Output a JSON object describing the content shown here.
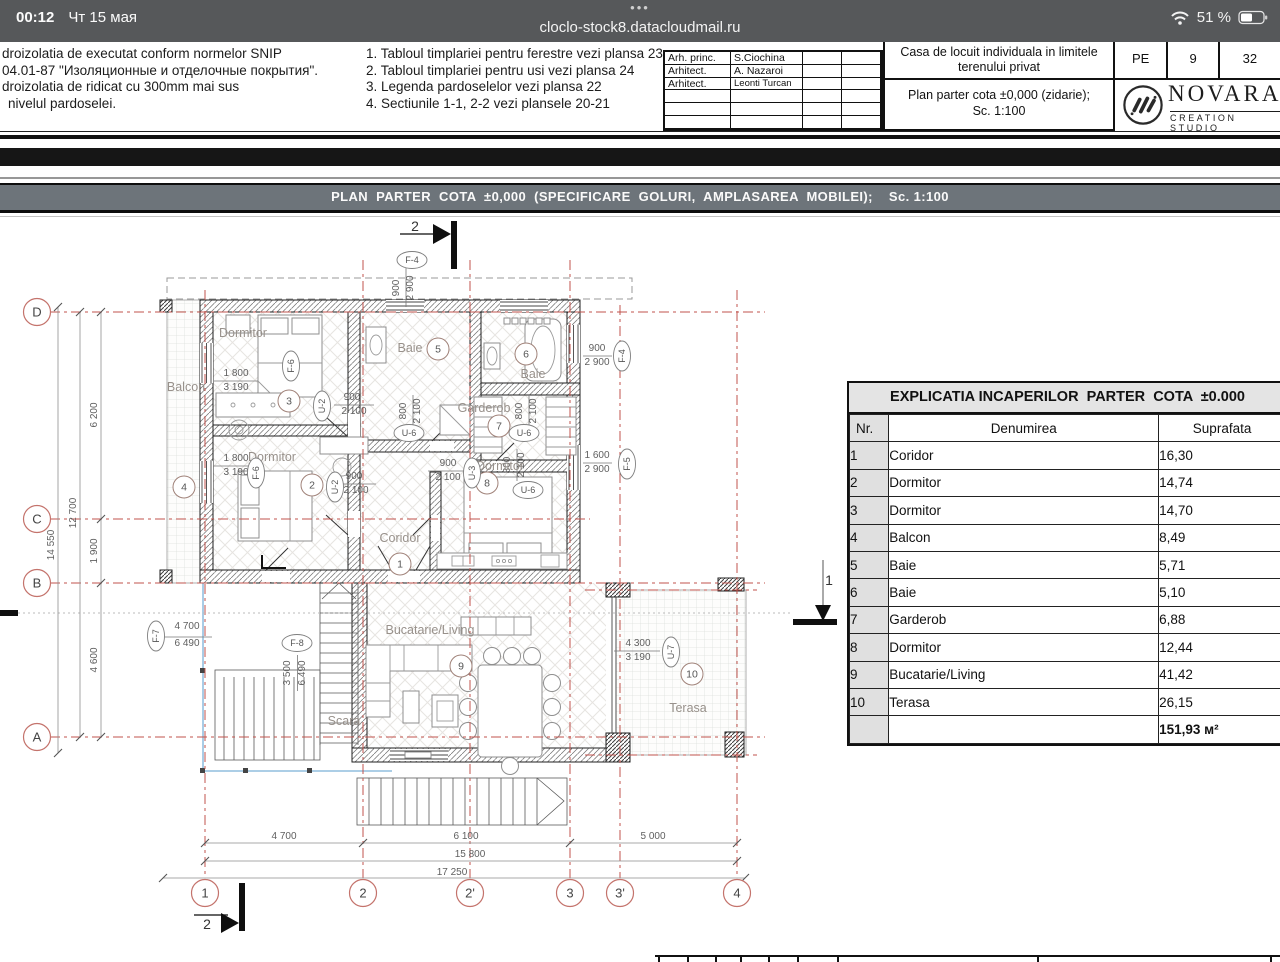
{
  "colors": {
    "accent_red": "#c0534c",
    "line_blue": "#7bb0d8",
    "banner_bg": "#6d747a",
    "status_bg": "#56585a"
  },
  "status_bar": {
    "time": "00:12",
    "date": "Чт 15 мая",
    "menu_dots": "•••",
    "url": "cloclo-stock8.datacloudmail.ru",
    "battery_percent": "51 %"
  },
  "title_block": {
    "notes_left": [
      "droizolatia de executat conform normelor SNIP",
      "04.01-87 \"Изоляционные и отделочные покрытия\".",
      "droizolatia de ridicat cu 300mm mai sus",
      "nivelul pardoselei."
    ],
    "notes_right": [
      "1. Tabloul timplariei pentru ferestre vezi plansa 23",
      "2. Tabloul timplariei pentru usi vezi plansa 24",
      "3. Legenda pardoselelor  vezi plansa 22",
      "4. Sectiunile 1-1, 2-2 vezi plansele 20-21"
    ],
    "roles": [
      {
        "role": "Arh. princ.",
        "name": "S.Ciochina"
      },
      {
        "role": "Arhitect.",
        "name": "A. Nazaroi"
      },
      {
        "role": "Arhitect.",
        "name": "Leonti Turcan"
      }
    ],
    "project_title": "Casa de locuit individuala in limitele terenului privat",
    "drawing_title": "Plan parter cota ±0,000 (zidarie);",
    "drawing_scale": "Sc. 1:100",
    "stage": "PE",
    "sheet_no": "9",
    "sheet_total": "32",
    "logo_name": "NOVARA",
    "logo_sub": "CREATION STUDIO"
  },
  "banner": {
    "text": "PLAN  PARTER  COTA  ±0,000  (SPECIFICARE  GOLURI,  AMPLASAREA  MOBILEI);    Sc. 1:100"
  },
  "plan": {
    "axis_letters": [
      {
        "t": "D",
        "x": 37,
        "y": 97
      },
      {
        "t": "C",
        "x": 37,
        "y": 304
      },
      {
        "t": "B",
        "x": 37,
        "y": 368
      },
      {
        "t": "A",
        "x": 37,
        "y": 522
      }
    ],
    "axis_numbers": [
      {
        "t": "1",
        "x": 205,
        "y": 678
      },
      {
        "t": "2",
        "x": 363,
        "y": 678
      },
      {
        "t": "2'",
        "x": 470,
        "y": 678
      },
      {
        "t": "3",
        "x": 570,
        "y": 678
      },
      {
        "t": "3'",
        "x": 620,
        "y": 678
      },
      {
        "t": "4",
        "x": 737,
        "y": 678
      }
    ],
    "circles": [
      {
        "t": "1",
        "x": 400,
        "y": 349
      },
      {
        "t": "2",
        "x": 312,
        "y": 270
      },
      {
        "t": "3",
        "x": 289,
        "y": 186
      },
      {
        "t": "4",
        "x": 184,
        "y": 272
      },
      {
        "t": "5",
        "x": 438,
        "y": 134
      },
      {
        "t": "6",
        "x": 526,
        "y": 139
      },
      {
        "t": "7",
        "x": 499,
        "y": 211
      },
      {
        "t": "8",
        "x": 487,
        "y": 268
      },
      {
        "t": "9",
        "x": 461,
        "y": 451
      },
      {
        "t": "10",
        "x": 692,
        "y": 459
      }
    ],
    "bubbles": [
      {
        "t": "F-4",
        "x": 412,
        "y": 45
      },
      {
        "t": "F-4",
        "x": 622,
        "y": 141,
        "v": 1
      },
      {
        "t": "F-5",
        "x": 627,
        "y": 249,
        "v": 1
      },
      {
        "t": "F-6",
        "x": 291,
        "y": 151,
        "v": 1
      },
      {
        "t": "F-6",
        "x": 256,
        "y": 258,
        "v": 1
      },
      {
        "t": "F-7",
        "x": 156,
        "y": 421,
        "v": 1
      },
      {
        "t": "F-8",
        "x": 297,
        "y": 428
      },
      {
        "t": "U-2",
        "x": 322,
        "y": 191,
        "v": 1
      },
      {
        "t": "U-2",
        "x": 335,
        "y": 272,
        "v": 1
      },
      {
        "t": "U-3",
        "x": 472,
        "y": 258,
        "v": 1
      },
      {
        "t": "U-6",
        "x": 409,
        "y": 218
      },
      {
        "t": "U-6",
        "x": 524,
        "y": 218
      },
      {
        "t": "U-6",
        "x": 528,
        "y": 275
      },
      {
        "t": "U-7",
        "x": 671,
        "y": 437,
        "v": 1
      }
    ],
    "rooms": [
      {
        "t": "Dormitor",
        "x": 243,
        "y": 122
      },
      {
        "t": "Dormitor",
        "x": 272,
        "y": 246
      },
      {
        "t": "Dormitor",
        "x": 500,
        "y": 255
      },
      {
        "t": "Baie",
        "x": 410,
        "y": 137
      },
      {
        "t": "Baie",
        "x": 533,
        "y": 163
      },
      {
        "t": "Garderob",
        "x": 484,
        "y": 197
      },
      {
        "t": "Coridor",
        "x": 400,
        "y": 327
      },
      {
        "t": "Balcon",
        "x": 186,
        "y": 176
      },
      {
        "t": "Bucatarie/Living",
        "x": 430,
        "y": 419
      },
      {
        "t": "Scara",
        "x": 344,
        "y": 510
      },
      {
        "t": "Terasa",
        "x": 688,
        "y": 497
      }
    ],
    "texts": [
      {
        "t": "14 550",
        "x": 54,
        "y": 330,
        "r": -90
      },
      {
        "t": "12 700",
        "x": 76,
        "y": 298,
        "r": -90
      },
      {
        "t": "6 200",
        "x": 97,
        "y": 200,
        "r": -90
      },
      {
        "t": "1 900",
        "x": 97,
        "y": 336,
        "r": -90
      },
      {
        "t": "4 600",
        "x": 97,
        "y": 445,
        "r": -90
      },
      {
        "t": "4 700",
        "x": 284,
        "y": 624
      },
      {
        "t": "6 100",
        "x": 466,
        "y": 624
      },
      {
        "t": "5 000",
        "x": 653,
        "y": 624
      },
      {
        "t": "15 800",
        "x": 470,
        "y": 642
      },
      {
        "t": "17 250",
        "x": 452,
        "y": 660
      },
      {
        "t": "900",
        "x": 399,
        "y": 73,
        "r": -90
      },
      {
        "t": "2 900",
        "x": 413,
        "y": 73,
        "r": -90
      },
      {
        "t": "900",
        "x": 597,
        "y": 136
      },
      {
        "t": "2 900",
        "x": 597,
        "y": 150
      },
      {
        "t": "1 600",
        "x": 597,
        "y": 243
      },
      {
        "t": "2 900",
        "x": 597,
        "y": 257
      },
      {
        "t": "1 800",
        "x": 236,
        "y": 161
      },
      {
        "t": "3 190",
        "x": 236,
        "y": 175
      },
      {
        "t": "1 800",
        "x": 236,
        "y": 246
      },
      {
        "t": "3 190",
        "x": 236,
        "y": 260
      },
      {
        "t": "900",
        "x": 352,
        "y": 185
      },
      {
        "t": "2 100",
        "x": 354,
        "y": 199
      },
      {
        "t": "900",
        "x": 354,
        "y": 264
      },
      {
        "t": "2 100",
        "x": 356,
        "y": 278
      },
      {
        "t": "900",
        "x": 448,
        "y": 251
      },
      {
        "t": "2 100",
        "x": 448,
        "y": 265
      },
      {
        "t": "800",
        "x": 406,
        "y": 196,
        "r": -90
      },
      {
        "t": "2 100",
        "x": 420,
        "y": 196,
        "r": -90
      },
      {
        "t": "800",
        "x": 522,
        "y": 196,
        "r": -90
      },
      {
        "t": "2 100",
        "x": 536,
        "y": 196,
        "r": -90
      },
      {
        "t": "800",
        "x": 510,
        "y": 250,
        "r": -90
      },
      {
        "t": "2 100",
        "x": 524,
        "y": 250,
        "r": -90
      },
      {
        "t": "4 700",
        "x": 187,
        "y": 414
      },
      {
        "t": "6 490",
        "x": 187,
        "y": 431
      },
      {
        "t": "3 500",
        "x": 290,
        "y": 458,
        "r": -90
      },
      {
        "t": "6 490",
        "x": 305,
        "y": 458,
        "r": -90
      },
      {
        "t": "4 300",
        "x": 638,
        "y": 431
      },
      {
        "t": "3 190",
        "x": 638,
        "y": 445
      },
      {
        "t": "2",
        "x": 415,
        "y": 16,
        "c": "sec"
      },
      {
        "t": "2",
        "x": 207,
        "y": 714,
        "c": "sec"
      },
      {
        "t": "1",
        "x": 829,
        "y": 370,
        "c": "sec"
      }
    ]
  },
  "room_table": {
    "title": "EXPLICATIA INCAPERILOR  PARTER  COTA  ±0.000",
    "headers": [
      "Nr.",
      "Denumirea",
      "Suprafata"
    ],
    "rows": [
      [
        "1",
        "Coridor",
        "16,30"
      ],
      [
        "2",
        "Dormitor",
        "14,74"
      ],
      [
        "3",
        "Dormitor",
        "14,70"
      ],
      [
        "4",
        "Balcon",
        "8,49"
      ],
      [
        "5",
        "Baie",
        "5,71"
      ],
      [
        "6",
        "Baie",
        "5,10"
      ],
      [
        "7",
        "Garderob",
        "6,88"
      ],
      [
        "8",
        "Dormitor",
        "12,44"
      ],
      [
        "9",
        "Bucatarie/Living",
        "41,42"
      ],
      [
        "10",
        "Terasa",
        "26,15"
      ]
    ],
    "total": "151,93 м²"
  }
}
